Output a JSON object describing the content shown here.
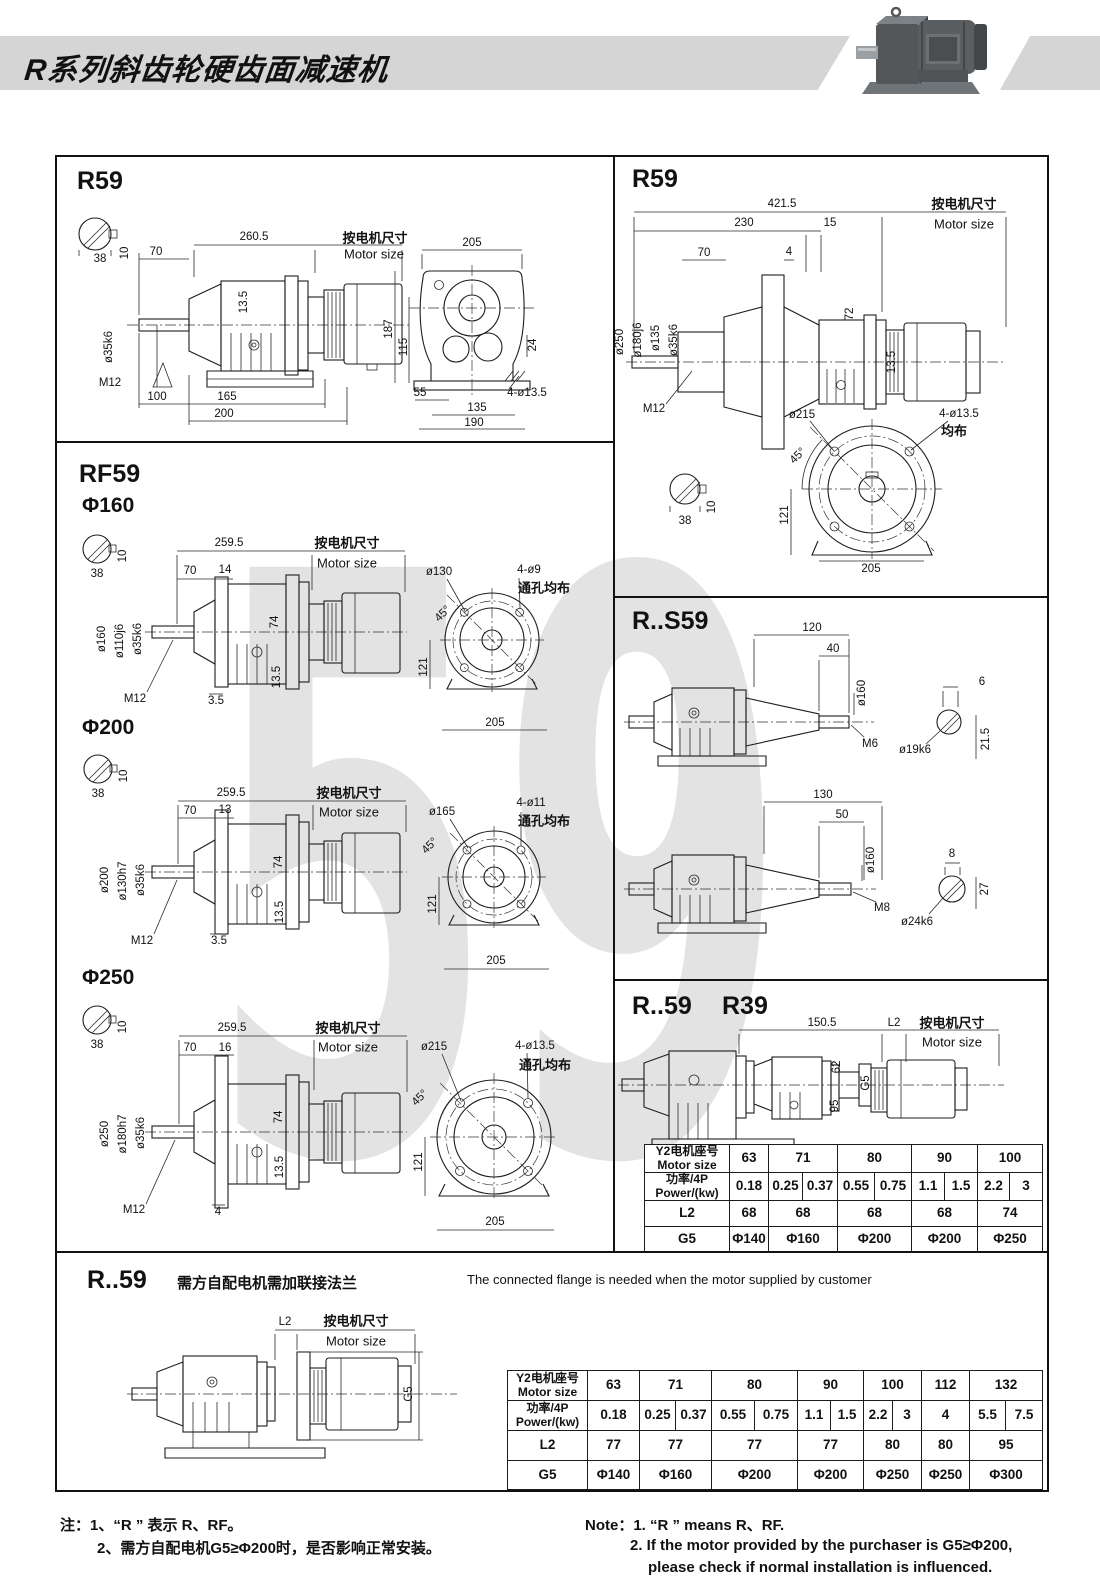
{
  "header": {
    "title": "R系列斜齿轮硬齿面减速机"
  },
  "watermark": "59",
  "common": {
    "motor_cn": "按电机尺寸",
    "motor_en": "Motor size",
    "shaft_w": "38",
    "shaft_k": "10"
  },
  "p1": {
    "title": "R59",
    "total": "260.5",
    "d70": "70",
    "d135": "13.5",
    "dia35": "ø35k6",
    "m12": "M12",
    "d100": "100",
    "d165": "165",
    "d200": "200",
    "r205": "205",
    "r187": "187",
    "r115": "115",
    "r24": "24",
    "r55": "55",
    "r135": "135",
    "r190": "190",
    "rholes": "4-ø13.5"
  },
  "p2": {
    "title": "R59",
    "total": "421.5",
    "d230": "230",
    "d15": "15",
    "d70": "70",
    "d4": "4",
    "dia250": "ø250",
    "dia180": "ø180j6",
    "dia135": "ø135",
    "dia35": "ø35k6",
    "d72": "72",
    "d135": "13.5",
    "m12": "M12",
    "f215": "ø215",
    "fholes": "4-ø13.5",
    "feven": "均布",
    "f45": "45°",
    "f121": "121",
    "f205": "205"
  },
  "p3": {
    "title": "RF59",
    "s160": {
      "head": "Φ160",
      "total": "259.5",
      "d70": "70",
      "dgap": "14",
      "diaA": "ø160",
      "diaB": "ø110j6",
      "diaC": "ø35k6",
      "d74": "74",
      "d135": "13.5",
      "m12": "M12",
      "doff": "3.5",
      "fdia": "ø130",
      "fholes": "4-ø9",
      "fthru": "通孔均布",
      "f45": "45°",
      "f121": "121",
      "f205": "205"
    },
    "s200": {
      "head": "Φ200",
      "total": "259.5",
      "d70": "70",
      "dgap": "13",
      "diaA": "ø200",
      "diaB": "ø130h7",
      "diaC": "ø35k6",
      "d74": "74",
      "d135": "13.5",
      "m12": "M12",
      "doff": "3.5",
      "fdia": "ø165",
      "fholes": "4-ø11",
      "fthru": "通孔均布",
      "f45": "45°",
      "f121": "121",
      "f205": "205"
    },
    "s250": {
      "head": "Φ250",
      "total": "259.5",
      "d70": "70",
      "dgap": "16",
      "diaA": "ø250",
      "diaB": "ø180h7",
      "diaC": "ø35k6",
      "d74": "74",
      "d135": "13.5",
      "m12": "M12",
      "doff": "4",
      "fdia": "ø215",
      "fholes": "4-ø13.5",
      "fthru": "通孔均布",
      "f45": "45°",
      "f121": "121",
      "f205": "205"
    }
  },
  "p4": {
    "title": "R..S59",
    "d1": {
      "l1": "120",
      "l2": "40",
      "dia": "ø160",
      "m": "M6",
      "key": "6",
      "shaft": "ø19k6",
      "h": "21.5"
    },
    "d2": {
      "l1": "130",
      "l2": "50",
      "dia": "ø160",
      "m": "M8",
      "key": "8",
      "shaft": "ø24k6",
      "h": "27"
    }
  },
  "p5": {
    "title1": "R..59",
    "title2": "R39",
    "d1505": "150.5",
    "l2": "L2",
    "d62": "62",
    "d95": "95",
    "g5": "G5",
    "table": {
      "row1_cn": "Y2电机座号",
      "row1_en": "Motor size",
      "row2_cn": "功率/4P",
      "row2_en": "Power/(kw)",
      "l2": "L2",
      "g5": "G5",
      "sizes": [
        "63",
        "71",
        "80",
        "90",
        "100"
      ],
      "powers": [
        "0.18",
        "0.25",
        "0.37",
        "0.55",
        "0.75",
        "1.1",
        "1.5",
        "2.2",
        "3"
      ],
      "l2v": [
        "68",
        "68",
        "68",
        "68",
        "74"
      ],
      "g5v": [
        "Φ140",
        "Φ160",
        "Φ200",
        "Φ200",
        "Φ250"
      ]
    }
  },
  "p6": {
    "title": "R..59",
    "sub_cn": "需方自配电机需加联接法兰",
    "note_en": "The connected flange is needed when the motor supplied by customer",
    "l2": "L2",
    "g5": "G5",
    "table": {
      "row1_cn": "Y2电机座号",
      "row1_en": "Motor size",
      "row2_cn": "功率/4P",
      "row2_en": "Power/(kw)",
      "l2": "L2",
      "g5": "G5",
      "sizes": [
        "63",
        "71",
        "80",
        "90",
        "100",
        "112",
        "132"
      ],
      "powers": [
        "0.18",
        "0.25",
        "0.37",
        "0.55",
        "0.75",
        "1.1",
        "1.5",
        "2.2",
        "3",
        "4",
        "5.5",
        "7.5"
      ],
      "l2v": [
        "77",
        "77",
        "77",
        "77",
        "80",
        "80",
        "95"
      ],
      "g5v": [
        "Φ140",
        "Φ160",
        "Φ200",
        "Φ200",
        "Φ250",
        "Φ250",
        "Φ300"
      ]
    }
  },
  "notes": {
    "cn1": "注：1、“R ” 表示 R、RF。",
    "cn2": "2、需方自配电机G5≥Φ200时，是否影响正常安装。",
    "en1": "Note：1. “R ”  means R、RF.",
    "en2": "2. If the motor provided by the purchaser is G5≥Φ200,",
    "en3": "please check if normal installation is influenced."
  }
}
